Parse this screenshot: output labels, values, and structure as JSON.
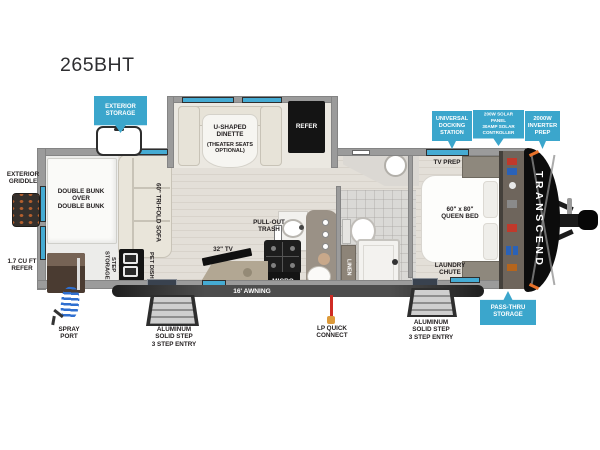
{
  "title": "265BHT",
  "brand": "TRANSCEND",
  "colors": {
    "accent": "#3BA6CC",
    "wall": "#9b9b9b",
    "window_blue": "#45ABD3",
    "appliance_black": "#141414"
  },
  "callouts": {
    "exterior_storage": "EXTERIOR\nSTORAGE",
    "universal_docking": "UNIVERSAL\nDOCKING\nSTATION",
    "solar": "200W SOLAR PANEL\n30AMP SOLAR\nCONTROLLER",
    "inverter": "2000W\nINVERTER\nPREP",
    "pass_thru": "PASS-THRU\nSTORAGE"
  },
  "exterior": {
    "griddle": "EXTERIOR\nGRIDDLE",
    "mini_refer": "1.7 CU FT\nREFER",
    "spray_port": "SPRAY\nPORT",
    "step_rear": "ALUMINUM\nSOLID STEP\n3 STEP ENTRY",
    "lp_connect": "LP QUICK\nCONNECT",
    "step_front": "ALUMINUM\nSOLID STEP\n3 STEP ENTRY",
    "awning": "16' AWNING"
  },
  "interior": {
    "bunks": "DOUBLE BUNK\nOVER\nDOUBLE BUNK",
    "dinette_title": "U-SHAPED\nDINETTE",
    "dinette_sub": "(THEATER SEATS\nOPTIONAL)",
    "refer": "REFER",
    "sofa": "60\" TRI-FOLD SOFA",
    "step_storage": "STEP\nSTORAGE",
    "pet_dish": "PET DISH",
    "trash": "PULL-OUT\nTRASH",
    "tv32": "32\" TV",
    "micro": "MICRO",
    "tv_prep": "TV PREP",
    "queen_bed": "60\" x 80\"\nQUEEN BED",
    "laundry": "LAUNDRY\nCHUTE",
    "linen": "LINEN"
  }
}
